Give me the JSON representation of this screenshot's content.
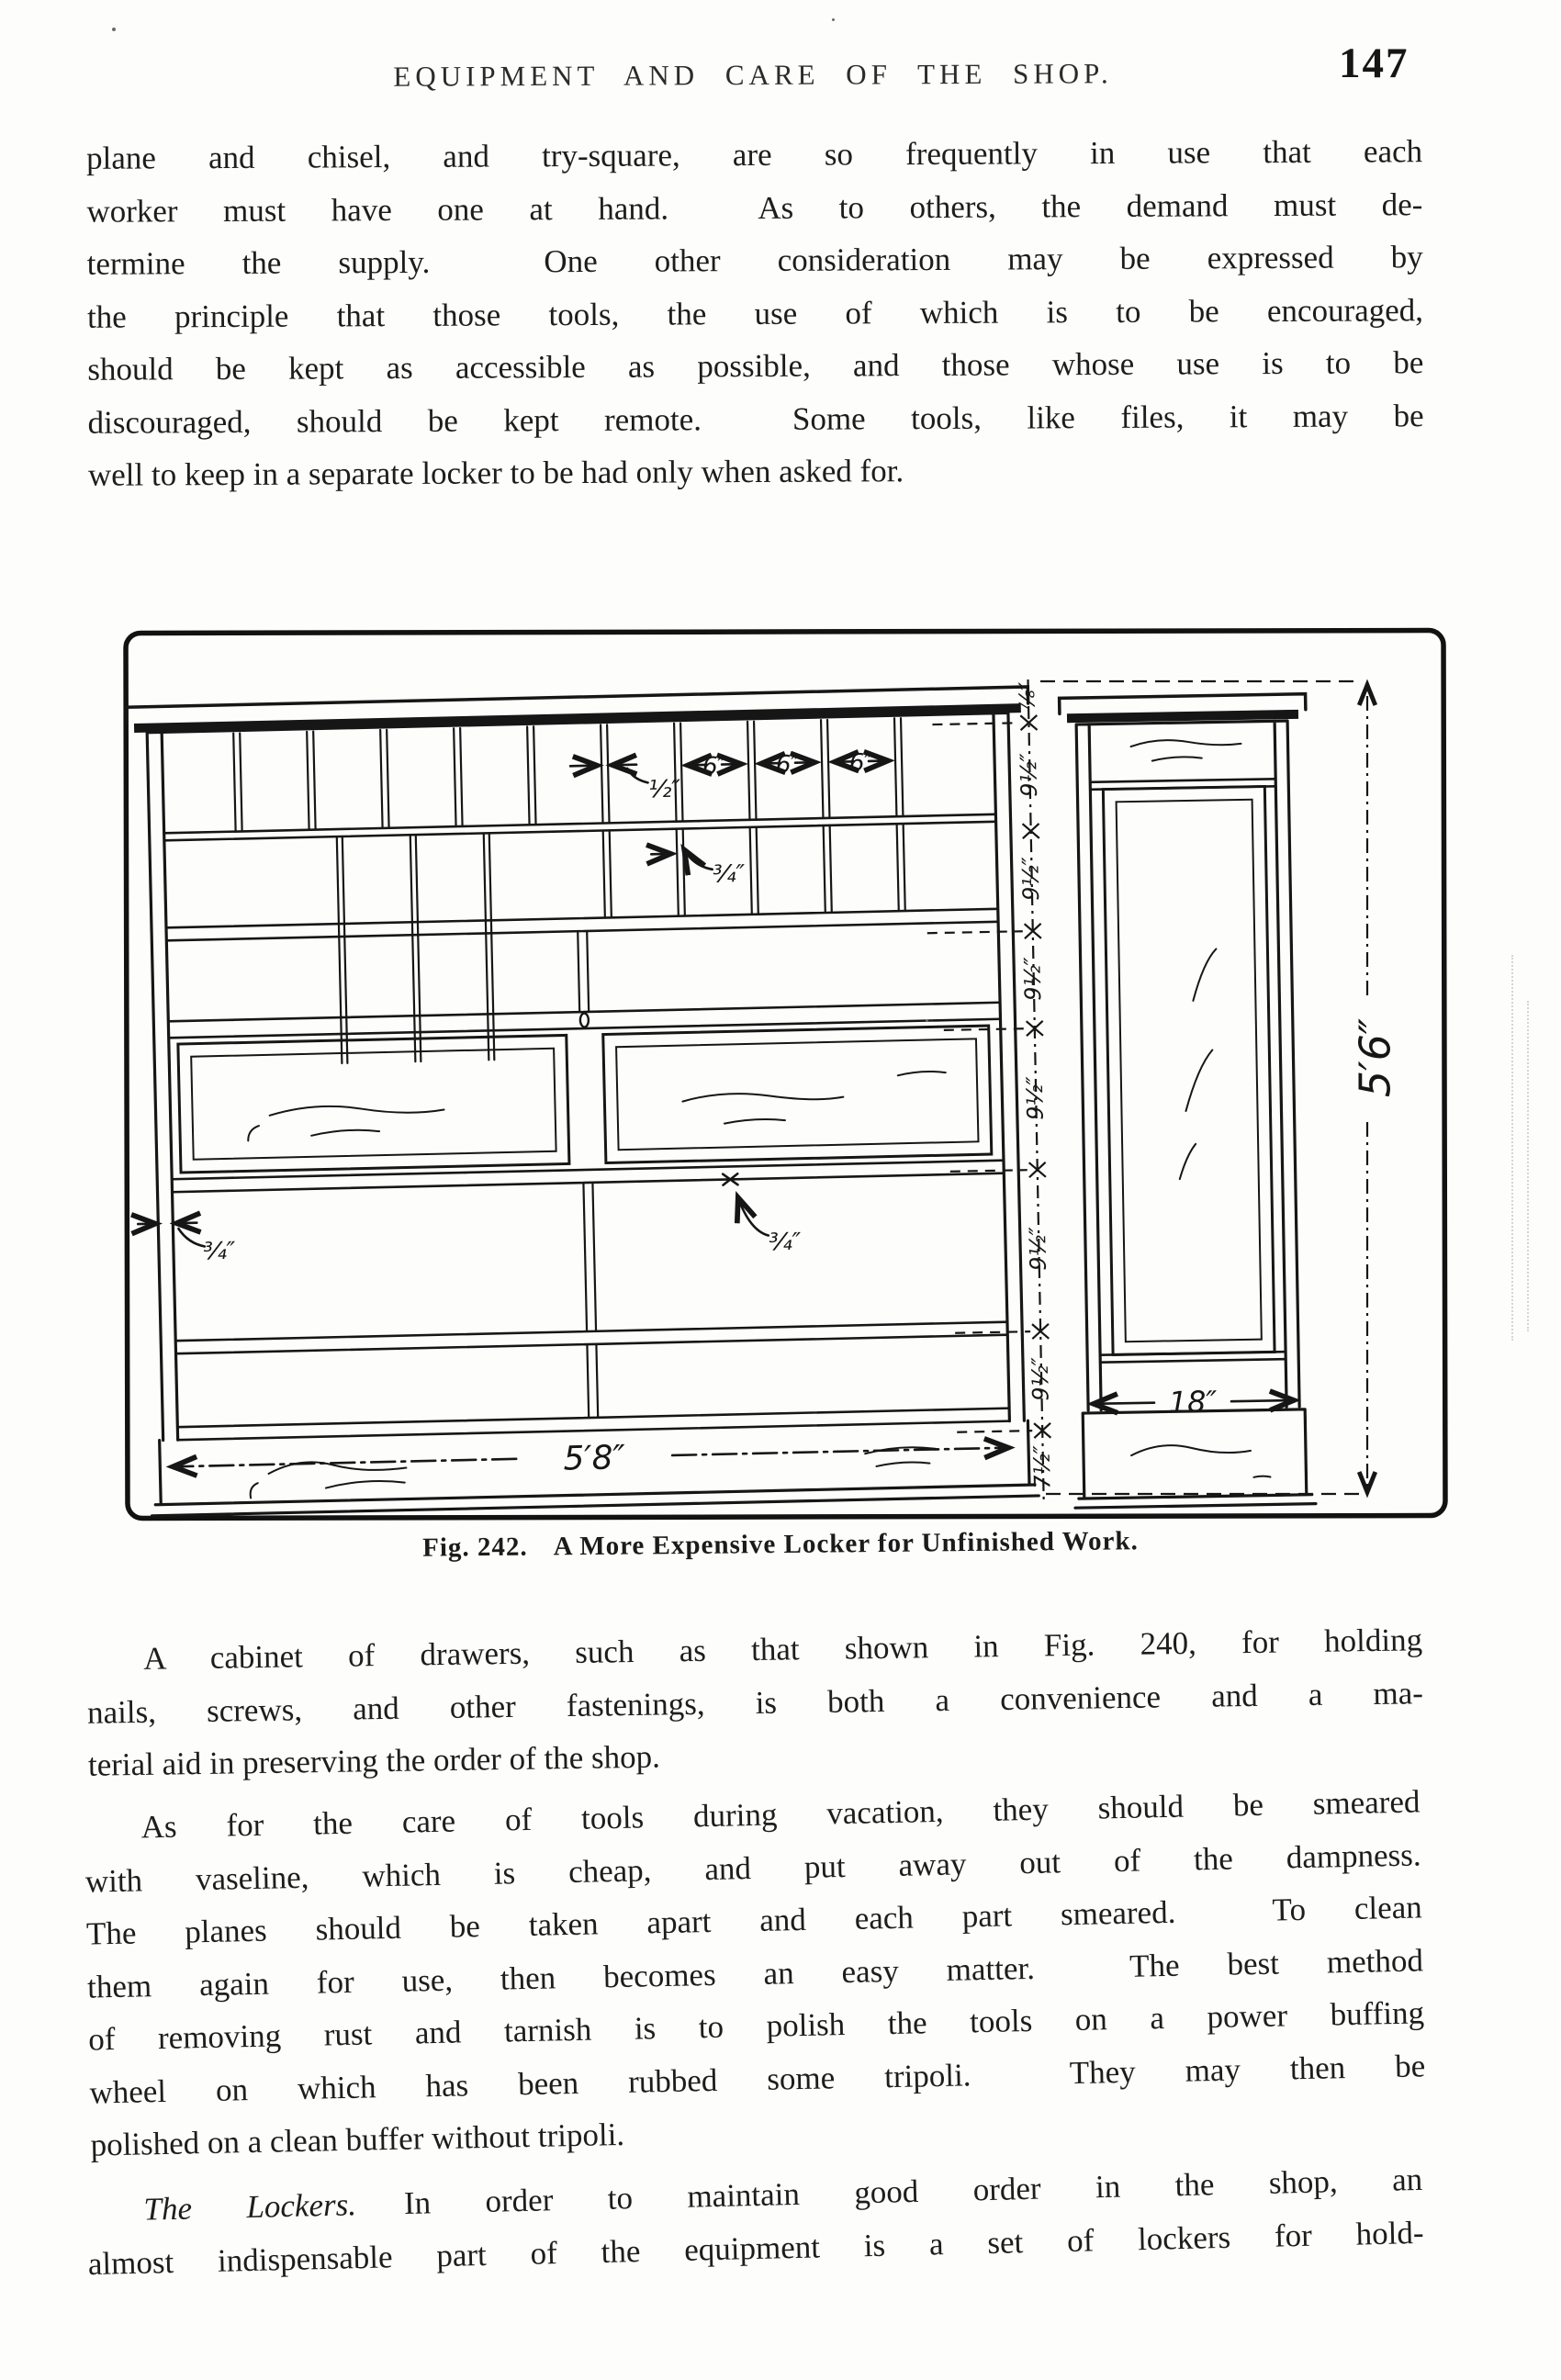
{
  "header": {
    "title": "EQUIPMENT AND CARE OF THE SHOP.",
    "page_number": "147"
  },
  "paragraphs": {
    "p1": {
      "lines": [
        "plane and chisel, and try-square, are so frequently in use that each",
        "worker must have one at hand.  As to others, the demand must de-",
        "termine the supply.  One other consideration may be expressed by",
        "the principle that those tools, the use of which is to be encouraged,",
        "should be kept as accessible as possible, and those whose use is to be",
        "discouraged, should be kept remote.  Some tools, like files, it may be",
        "well to keep in a separate locker to be had only when asked for."
      ]
    },
    "p2": {
      "lines": [
        "A cabinet of drawers, such as that shown in Fig. 240, for holding",
        "nails, screws, and other fastenings, is both a convenience and a ma-",
        "terial aid in preserving the order of the shop."
      ]
    },
    "p3": {
      "lines": [
        "As for the care of tools during vacation, they should be smeared",
        "with vaseline, which is cheap, and put away out of the dampness.",
        "The planes should be taken apart and each part smeared.  To clean",
        "them again for use, then becomes an easy matter.  The best method",
        "of removing rust and tarnish is to polish the tools on a power buffing",
        "wheel on which has been rubbed some tripoli.  They may then be",
        "polished on a clean buffer without tripoli."
      ]
    },
    "p4": {
      "lead": "The Lockers.",
      "line1_rest": "In order to maintain good order in the shop, an",
      "line2": "almost indispensable part of the equipment is a set of lockers for hold-"
    }
  },
  "figure": {
    "caption": {
      "fig_label": "Fig. 242.",
      "title": "A More Expensive Locker for Unfinished Work."
    },
    "dims": {
      "slat_width": "½″",
      "slat_spacing": "6″",
      "board_thickness": "¾″",
      "top_gap": "⅞″",
      "shelf_spacing": "9½″",
      "base_height": "7½″",
      "front_width": "5′8″",
      "side_width": "18″",
      "overall_height": "5′6″"
    }
  }
}
